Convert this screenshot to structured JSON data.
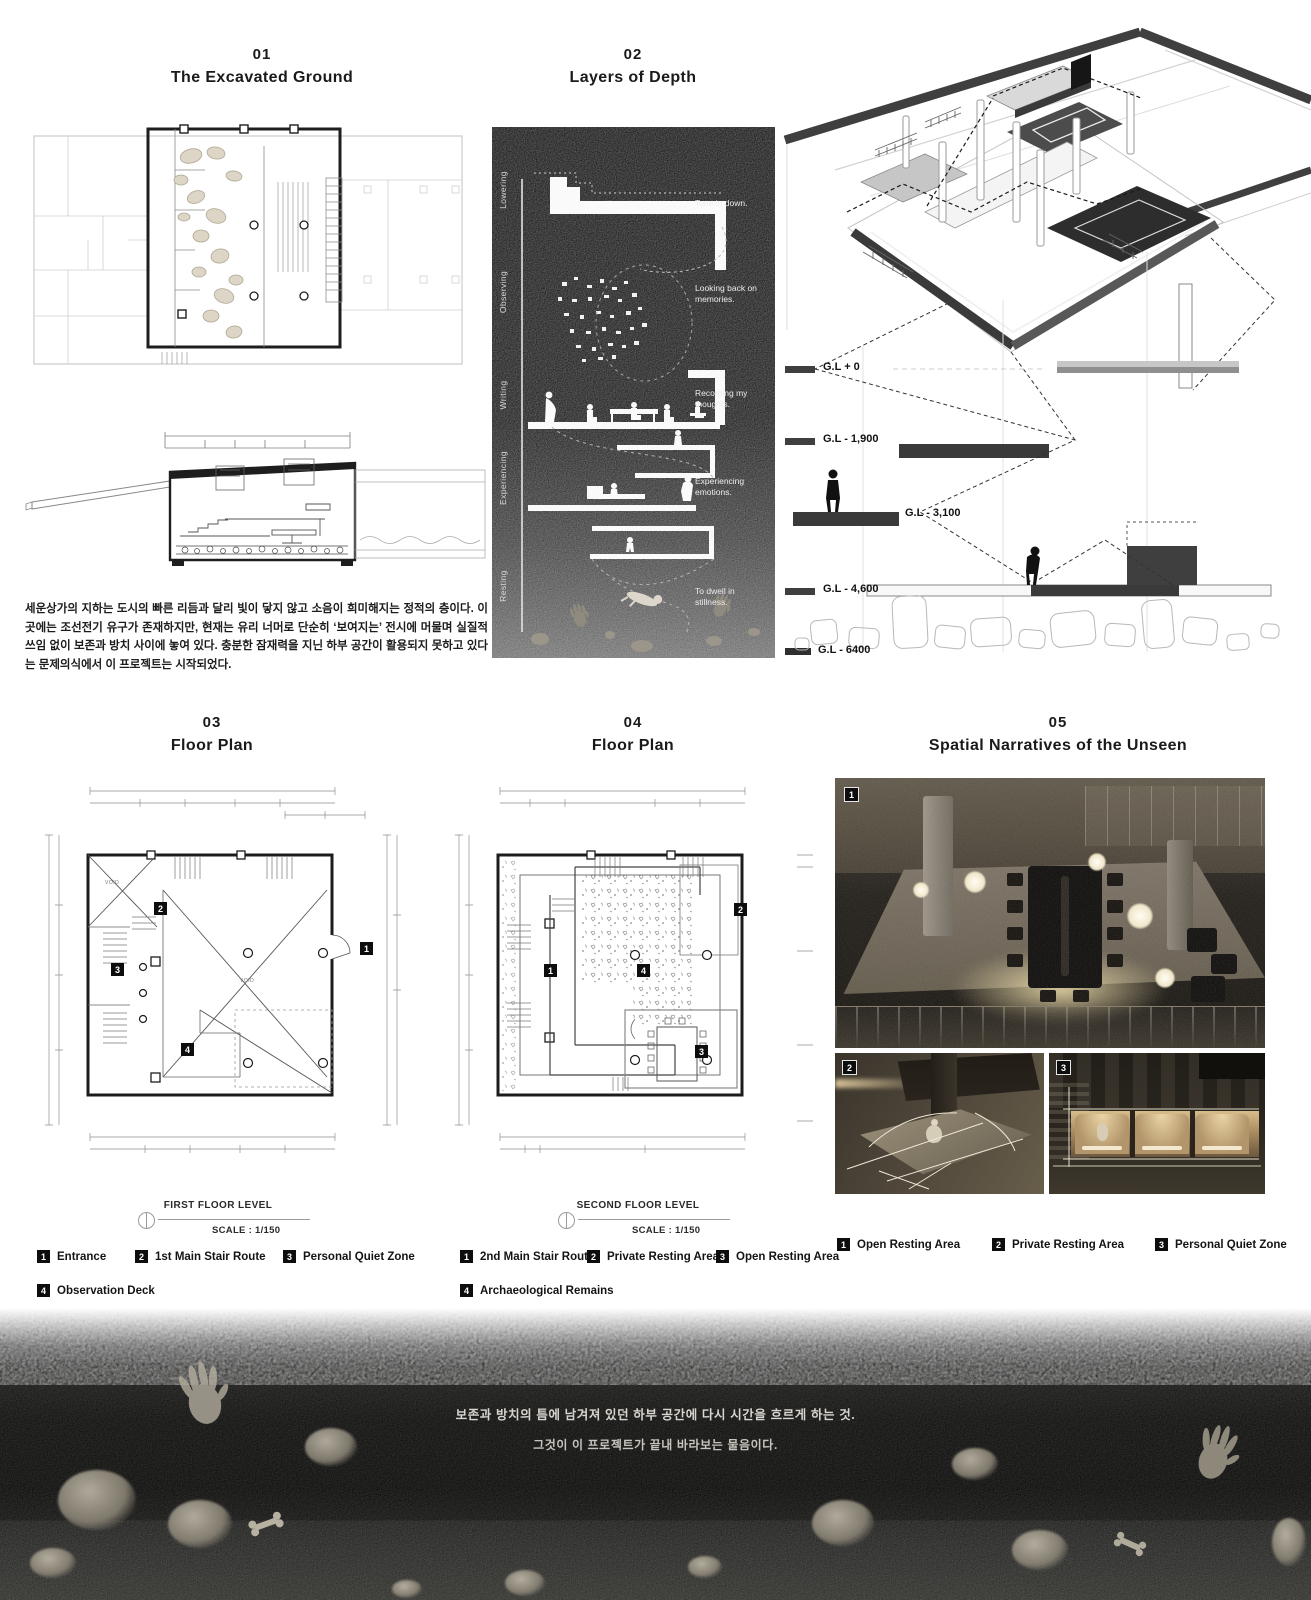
{
  "p01": {
    "number": "01",
    "title": "The Excavated Ground",
    "paragraph": "세운상가의 지하는 도시의 빠른 리듬과 달리 빛이 닿지 않고 소음이 희미해지는 정적의 층이다. 이곳에는 조선전기 유구가 존재하지만, 현재는 유리 너머로 단순히 ‘보여지는’ 전시에 머물며 실질적 쓰임 없이 보존과 방치 사이에 놓여 있다. 충분한 잠재력을 지닌 하부 공간이 활용되지 못하고 있다는 문제의식에서 이 프로젝트는 시작되었다."
  },
  "p02": {
    "number": "02",
    "title": "Layers of Depth",
    "stages": [
      "Lowering",
      "Observing",
      "Writing",
      "Experiencing",
      "Resting"
    ],
    "annotations": [
      "Tone in down.",
      "Looking back on memories.",
      "Recording my thoughts.",
      "Experiencing emotions.",
      "To dwell in stillness."
    ]
  },
  "sectionDiagram": {
    "levels": [
      "G.L + 0",
      "G.L - 1,900",
      "G.L - 3,100",
      "G.L - 4,600",
      "G.L - 6400"
    ]
  },
  "p03": {
    "number": "03",
    "title": "Floor Plan",
    "caption": "FIRST FLOOR LEVEL",
    "scale": "SCALE : 1/150",
    "void_label": "VOID",
    "markers": [
      "1",
      "2",
      "3",
      "4"
    ],
    "legend": [
      {
        "num": "1",
        "label": "Entrance"
      },
      {
        "num": "2",
        "label": "1st Main Stair Route"
      },
      {
        "num": "3",
        "label": "Personal Quiet Zone"
      },
      {
        "num": "4",
        "label": "Observation Deck"
      }
    ]
  },
  "p04": {
    "number": "04",
    "title": "Floor Plan",
    "caption": "SECOND FLOOR LEVEL",
    "scale": "SCALE : 1/150",
    "markers": [
      "1",
      "2",
      "3",
      "4"
    ],
    "legend": [
      {
        "num": "1",
        "label": "2nd Main Stair Route"
      },
      {
        "num": "2",
        "label": "Private Resting Area"
      },
      {
        "num": "3",
        "label": "Open Resting Area"
      },
      {
        "num": "4",
        "label": "Archaeological Remains"
      }
    ]
  },
  "p05": {
    "number": "05",
    "title": "Spatial Narratives of the Unseen",
    "markers": [
      "1",
      "2",
      "3"
    ],
    "legend": [
      {
        "num": "1",
        "label": "Open Resting Area"
      },
      {
        "num": "2",
        "label": "Private Resting Area"
      },
      {
        "num": "3",
        "label": "Personal Quiet Zone"
      }
    ]
  },
  "footer": {
    "line1": "보존과 방치의 틈에 남겨져 있던 하부 공간에 다시 시간을 흐르게 하는 것.",
    "line2": "그것이 이 프로젝트가 끝내 바라보는 물음이다."
  },
  "colors": {
    "ink": "#1a1a1a",
    "dark_band": "#3f3f3f",
    "warm_glow": "#e8d9b0"
  }
}
